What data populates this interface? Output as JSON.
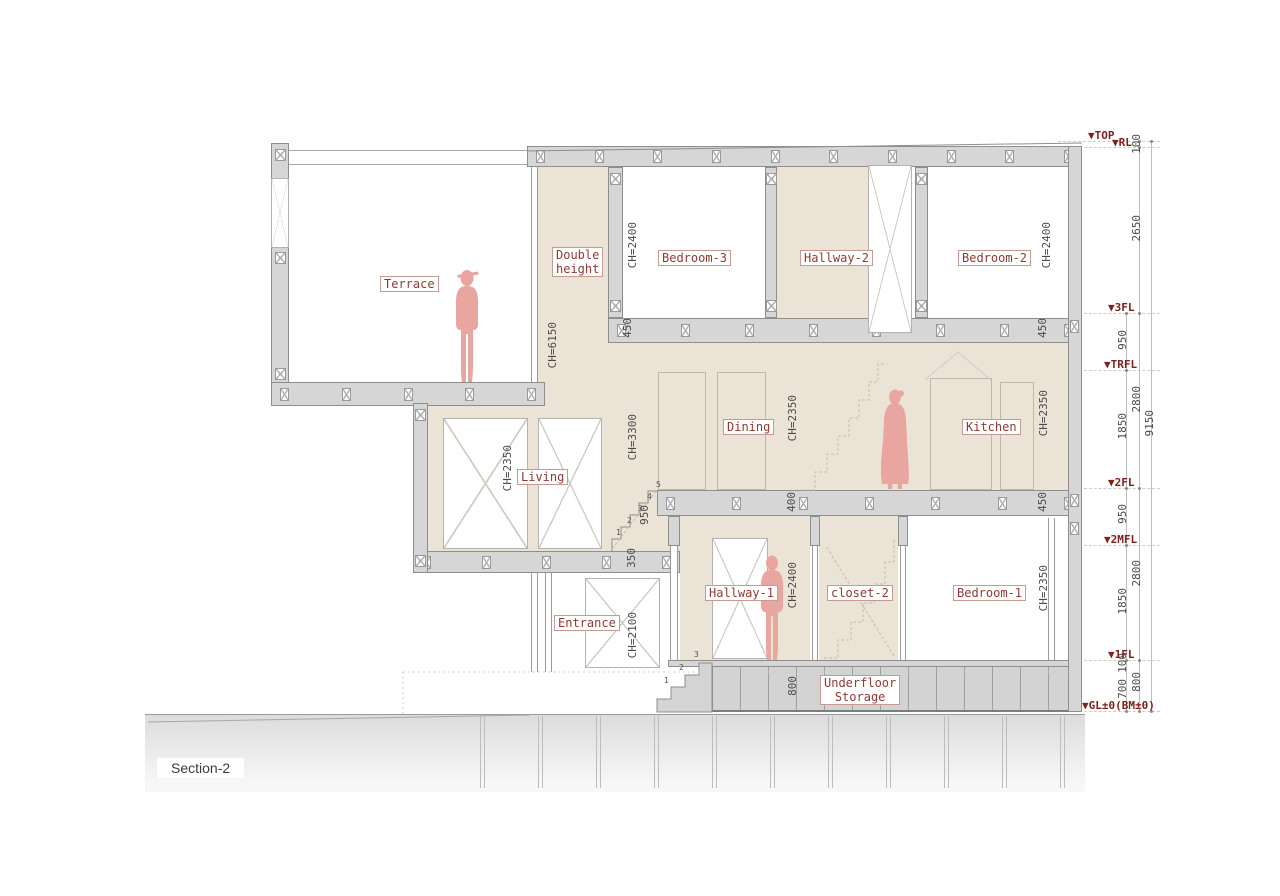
{
  "section_label": "Section-2",
  "marker_glyph": "▼",
  "rooms": {
    "terrace": "Terrace",
    "double_height_line1": "Double",
    "double_height_line2": "height",
    "bedroom3": "Bedroom-3",
    "hallway2": "Hallway-2",
    "bedroom2": "Bedroom-2",
    "living": "Living",
    "dining": "Dining",
    "kitchen": "Kitchen",
    "entrance": "Entrance",
    "hallway1": "Hallway-1",
    "closet2": "closet-2",
    "bedroom1": "Bedroom-1",
    "underfloor_line1": "Underfloor",
    "underfloor_line2": "Storage"
  },
  "ceiling_heights": {
    "double_height": "CH=6150",
    "bedroom3": "CH=2400",
    "bedroom2": "CH=2400",
    "stair_hall": "CH=3300",
    "dining": "CH=2350",
    "kitchen": "CH=2350",
    "living": "CH=2350",
    "entrance": "CH=2100",
    "hallway1": "CH=2400",
    "bedroom1": "CH=2350"
  },
  "slab_dimensions": {
    "third_floor_left": "450",
    "third_floor_right": "450",
    "second_floor_mid": "400",
    "second_floor_right": "450",
    "mid_floor": "350",
    "stair_rise": "950",
    "underfloor_depth": "800"
  },
  "levels": [
    {
      "label": "TOP"
    },
    {
      "label": "RL"
    },
    {
      "label": "3FL"
    },
    {
      "label": "TRFL"
    },
    {
      "label": "2FL"
    },
    {
      "label": "2MFL"
    },
    {
      "label": "1FL"
    },
    {
      "label": "GL±0(BM±0)"
    }
  ],
  "dims_inner": [
    "950",
    "1850",
    "950",
    "1850",
    "100",
    "700"
  ],
  "dims_outer": [
    "100",
    "2650",
    "2800",
    "2800",
    "800"
  ],
  "dim_total": "9150",
  "stair_numbers": [
    "1",
    "2",
    "3",
    "4",
    "5"
  ],
  "entrance_step_numbers": [
    "1",
    "2",
    "3"
  ]
}
